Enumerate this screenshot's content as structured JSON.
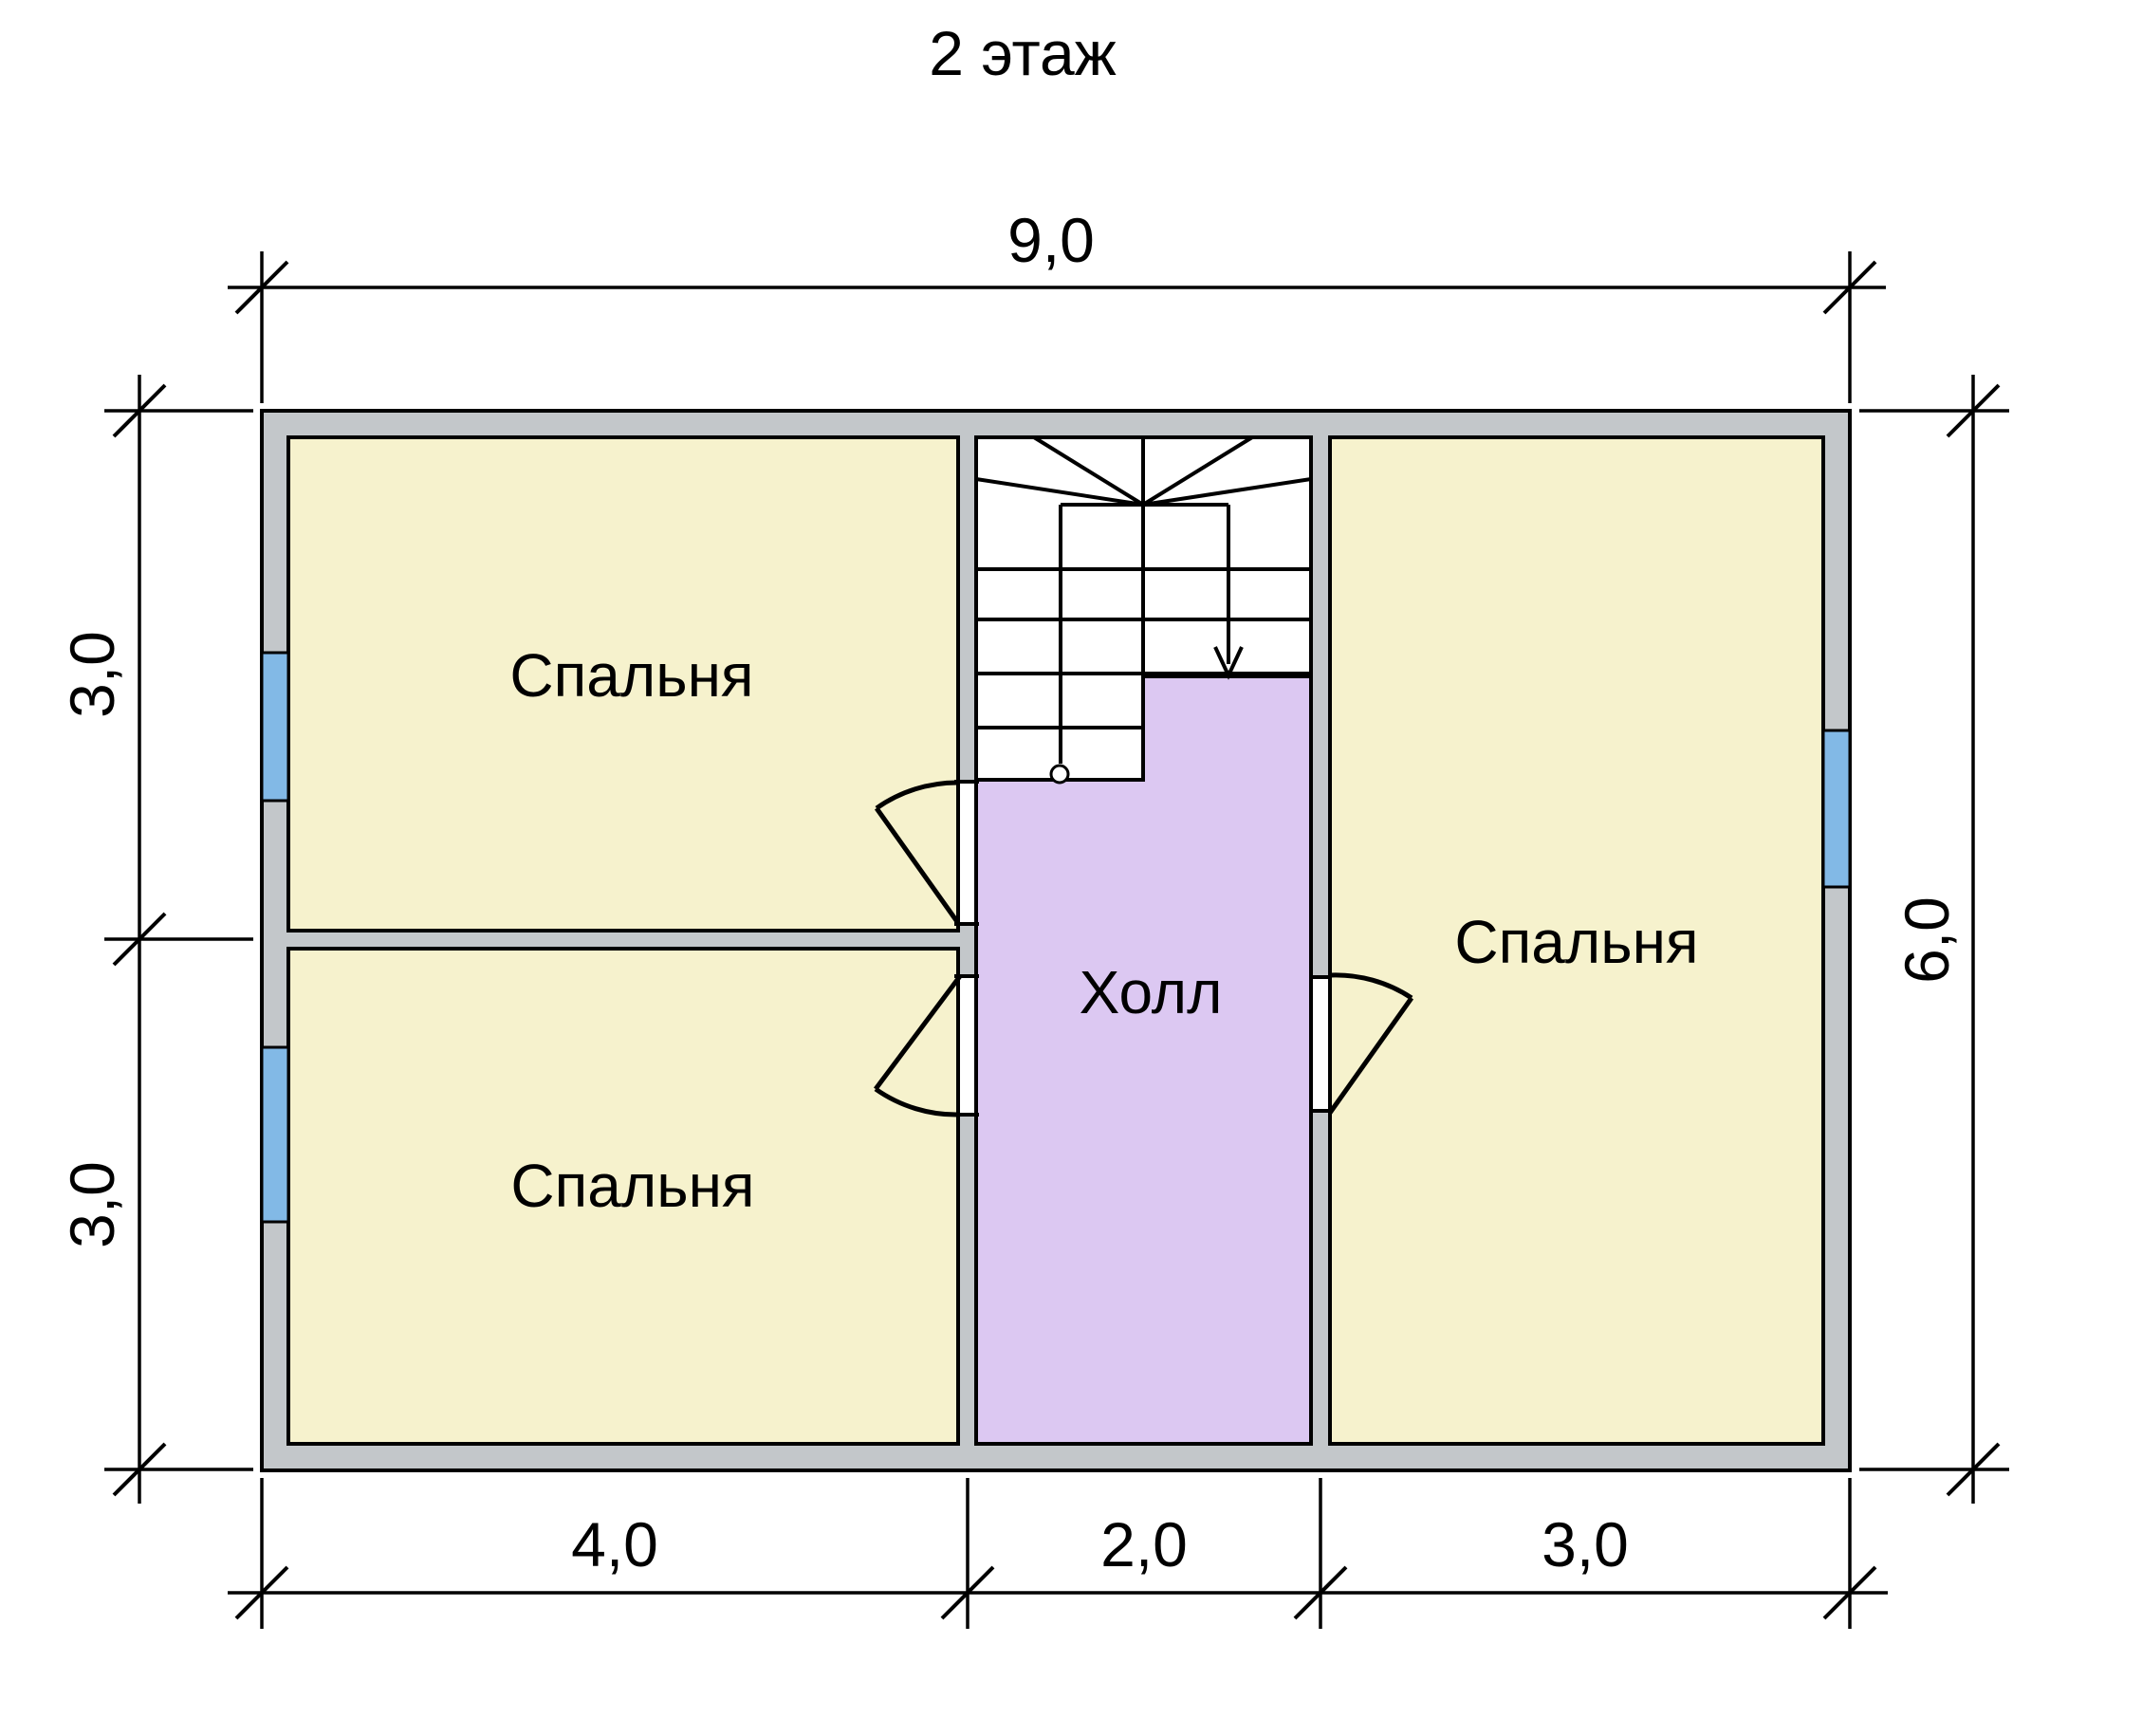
{
  "title": "2 этаж",
  "colors": {
    "wall": "#c3c7ca",
    "room": "#f6f2cd",
    "hall": "#dcc8f2",
    "window": "#82b9e6",
    "stair": "#ffffff",
    "line": "#000000"
  },
  "rooms": {
    "bedroom1": {
      "label": "Спальня"
    },
    "bedroom2": {
      "label": "Спальня"
    },
    "bedroom3": {
      "label": "Спальня"
    },
    "hall": {
      "label": "Холл"
    }
  },
  "dimensions": {
    "width_total": "9,0",
    "height_total": "6,0",
    "left_top": "3,0",
    "left_bottom": "3,0",
    "bottom_left": "4,0",
    "bottom_middle": "2,0",
    "bottom_right": "3,0"
  }
}
